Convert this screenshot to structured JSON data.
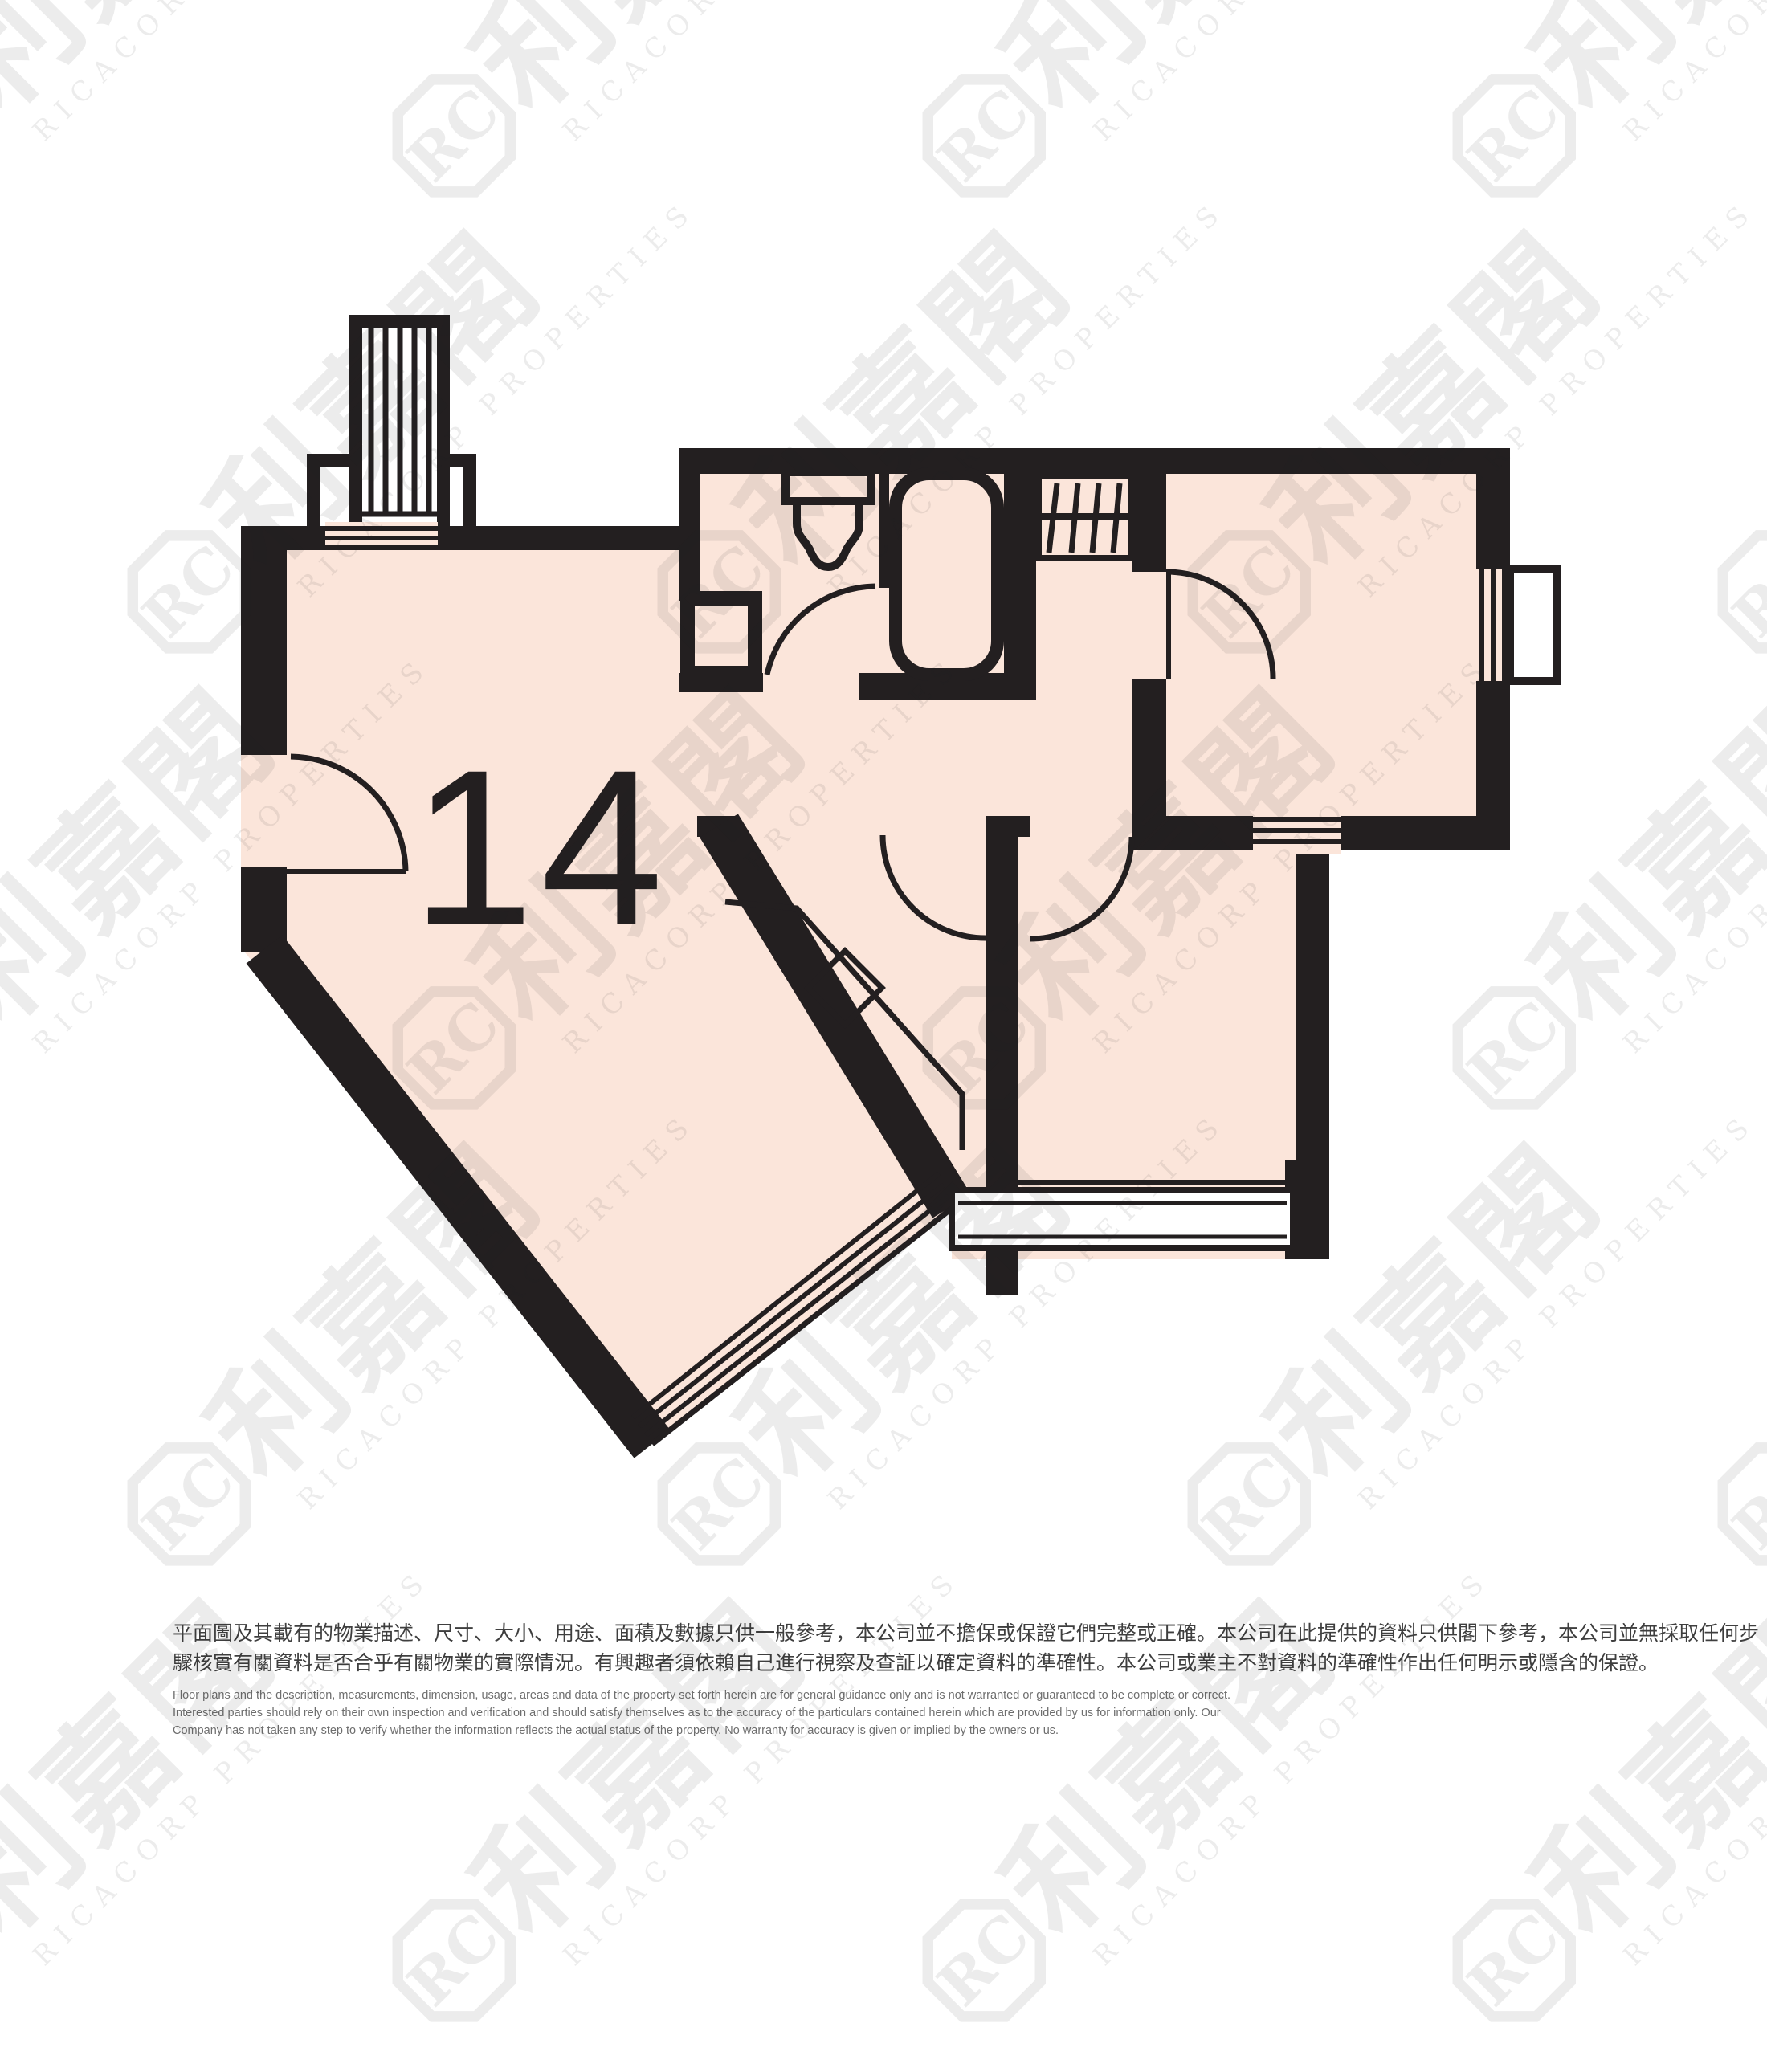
{
  "floor_plan": {
    "unit_label": "14",
    "colors": {
      "wall": "#231f20",
      "room_fill": "#fbe5da",
      "background": "#ffffff"
    }
  },
  "watermark": {
    "monogram": "RC",
    "chars": "利嘉閣",
    "latin": "RICACORP PROPERTIES"
  },
  "disclaimer": {
    "chinese": [
      "平面圖及其載有的物業描述、尺寸、大小、用途、面積及數據只供一般參考，本公司並不擔保或保證它們完整或正確。本公司在此提供的資料只供閣下參考，本公司並無採取任何步",
      "驟核實有關資料是否合乎有關物業的實際情況。有興趣者須依賴自己進行視察及查証以確定資料的準確性。本公司或業主不對資料的準確性作出任何明示或隱含的保證。"
    ],
    "english": [
      "Floor plans and the description, measurements, dimension, usage, areas and data of the property set forth herein are for general guidance only and is not warranted or guaranteed to be complete or correct.",
      "Interested parties should rely on their own inspection and verification and should satisfy themselves as to the accuracy of the particulars contained herein which are provided by us for information only.  Our",
      "Company has not taken any step to verify whether the information reflects the actual status of the property.  No warranty for accuracy is given or implied by the owners or us."
    ]
  }
}
